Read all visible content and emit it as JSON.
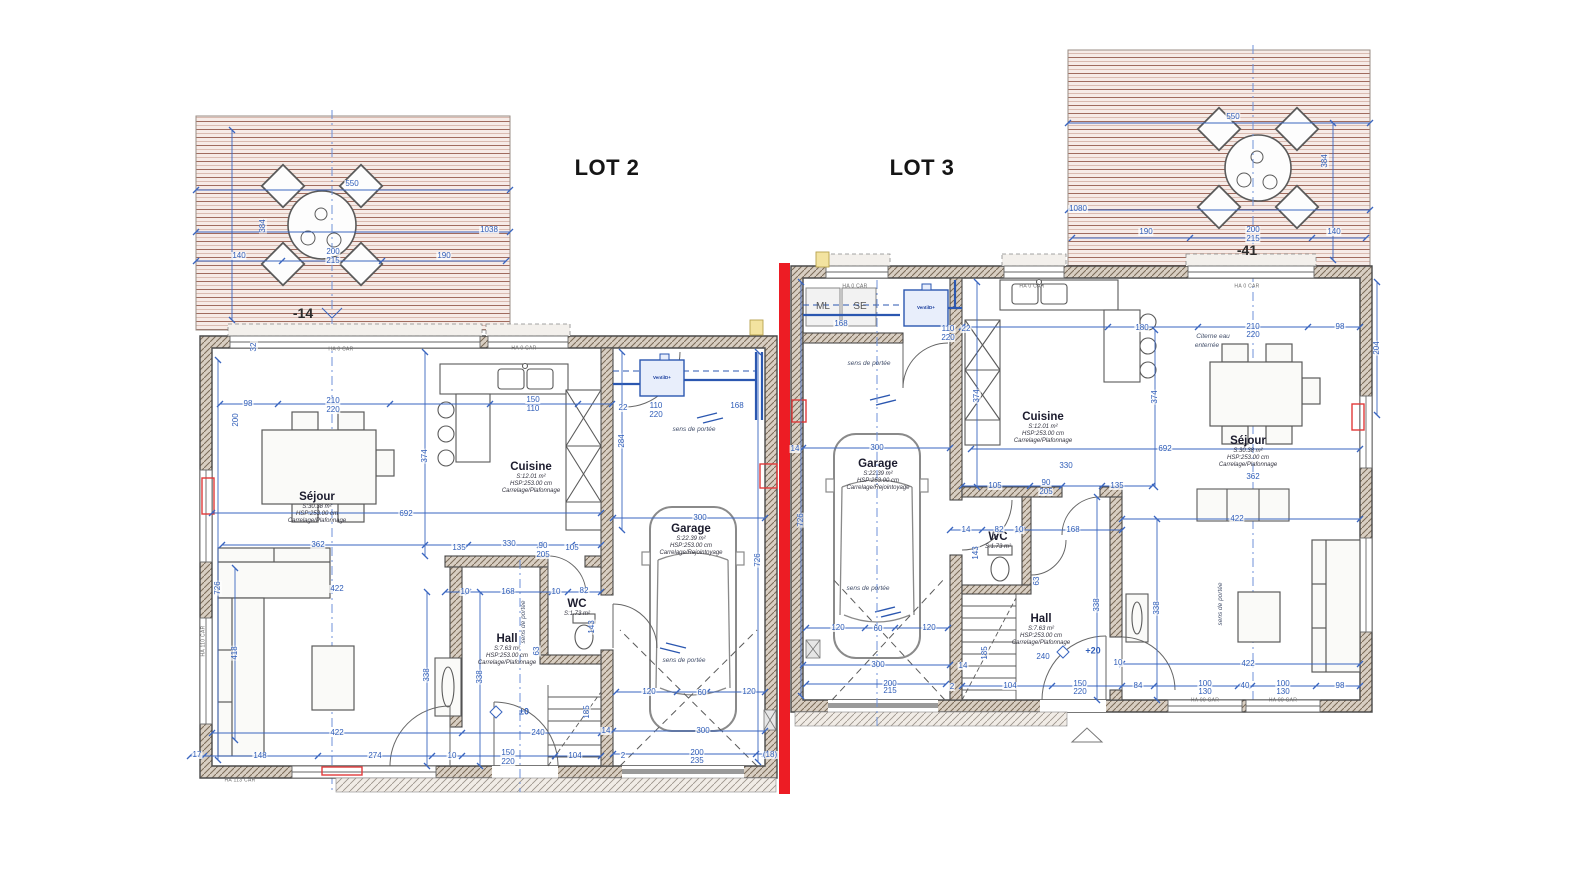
{
  "lots": {
    "lot2": "LOT 2",
    "lot3": "LOT 3"
  },
  "colors": {
    "dimension_blue": "#3a66c0",
    "axis_blue": "#6f92d8",
    "separation_red": "#ed1c24",
    "wall_gray": "#4a4a4a",
    "terrace_line": "#a06b5e",
    "terrace_bg": "#f6ebe7",
    "pipe_blue": "#2b57b0",
    "radiator_red": "#e03a3a"
  },
  "rooms": [
    {
      "name": "Séjour",
      "area": "S:30.38 m²",
      "hsp": "HSP:253.00 cm",
      "finish": "Carrelage/Plafonnage",
      "x": 317,
      "y": 508
    },
    {
      "name": "Cuisine",
      "area": "S:12.01 m²",
      "hsp": "HSP:253.00 cm",
      "finish": "Carrelage/Plafonnage",
      "x": 531,
      "y": 478
    },
    {
      "name": "Garage",
      "area": "S:22.39 m²",
      "hsp": "HSP:253.00 cm",
      "finish": "Carrelage/Rejointoyage",
      "x": 691,
      "y": 540
    },
    {
      "name": "Hall",
      "area": "S:7.63 m²",
      "hsp": "HSP:253.00 cm",
      "finish": "Carrelage/Plafonnage",
      "x": 507,
      "y": 650
    },
    {
      "name": "WC",
      "area": "S:1.73 m²",
      "x": 577,
      "y": 608
    },
    {
      "name": "Garage",
      "area": "S:22.39 m²",
      "hsp": "HSP:253.00 cm",
      "finish": "Carrelage/Rejointoyage",
      "x": 878,
      "y": 475
    },
    {
      "name": "Cuisine",
      "area": "S:12.01 m²",
      "hsp": "HSP:253.00 cm",
      "finish": "Carrelage/Plafonnage",
      "x": 1043,
      "y": 428
    },
    {
      "name": "Séjour",
      "area": "S:30.38 m²",
      "hsp": "HSP:253.00 cm",
      "finish": "Carrelage/Plafonnage",
      "x": 1248,
      "y": 452
    },
    {
      "name": "Hall",
      "area": "S:7.63 m²",
      "hsp": "HSP:253.00 cm",
      "finish": "Carrelage/Plafonnage",
      "x": 1041,
      "y": 630
    },
    {
      "name": "WC",
      "area": "S:1.73 m²",
      "x": 998,
      "y": 541
    }
  ],
  "dimensions": [
    {
      "t": "550",
      "x": 352,
      "y": 184
    },
    {
      "t": "1038",
      "x": 489,
      "y": 230
    },
    {
      "t": "384",
      "x": 263,
      "y": 226,
      "cls": "v"
    },
    {
      "t": "140",
      "x": 239,
      "y": 256
    },
    {
      "t": "190",
      "x": 444,
      "y": 256
    },
    {
      "t": "200",
      "x": 333,
      "y": 252
    },
    {
      "t": "215",
      "x": 333,
      "y": 261
    },
    {
      "t": "550",
      "x": 1233,
      "y": 117
    },
    {
      "t": "384",
      "x": 1325,
      "y": 161,
      "cls": "v"
    },
    {
      "t": "1080",
      "x": 1078,
      "y": 209
    },
    {
      "t": "190",
      "x": 1146,
      "y": 232
    },
    {
      "t": "200",
      "x": 1253,
      "y": 230
    },
    {
      "t": "215",
      "x": 1253,
      "y": 239
    },
    {
      "t": "140",
      "x": 1334,
      "y": 232
    },
    {
      "t": "98",
      "x": 248,
      "y": 404
    },
    {
      "t": "210",
      "x": 333,
      "y": 401
    },
    {
      "t": "220",
      "x": 333,
      "y": 410
    },
    {
      "t": "150",
      "x": 533,
      "y": 400
    },
    {
      "t": "110",
      "x": 533,
      "y": 409
    },
    {
      "t": "22",
      "x": 623,
      "y": 408
    },
    {
      "t": "110",
      "x": 656,
      "y": 406
    },
    {
      "t": "220",
      "x": 656,
      "y": 415
    },
    {
      "t": "168",
      "x": 737,
      "y": 406
    },
    {
      "t": "284",
      "x": 622,
      "y": 441,
      "cls": "v"
    },
    {
      "t": "374",
      "x": 425,
      "y": 456,
      "cls": "v"
    },
    {
      "t": "200",
      "x": 236,
      "y": 420,
      "cls": "v"
    },
    {
      "t": "32",
      "x": 254,
      "y": 347,
      "cls": "v"
    },
    {
      "t": "692",
      "x": 406,
      "y": 514
    },
    {
      "t": "362",
      "x": 318,
      "y": 545
    },
    {
      "t": "135",
      "x": 459,
      "y": 548
    },
    {
      "t": "330",
      "x": 509,
      "y": 544
    },
    {
      "t": "90",
      "x": 543,
      "y": 546
    },
    {
      "t": "205",
      "x": 543,
      "y": 555
    },
    {
      "t": "105",
      "x": 572,
      "y": 548
    },
    {
      "t": "300",
      "x": 700,
      "y": 518
    },
    {
      "t": "726",
      "x": 218,
      "y": 588,
      "cls": "v"
    },
    {
      "t": "726",
      "x": 758,
      "y": 560,
      "cls": "v"
    },
    {
      "t": "422",
      "x": 337,
      "y": 589
    },
    {
      "t": "10",
      "x": 465,
      "y": 592
    },
    {
      "t": "168",
      "x": 508,
      "y": 592
    },
    {
      "t": "10",
      "x": 556,
      "y": 592
    },
    {
      "t": "82",
      "x": 584,
      "y": 591
    },
    {
      "t": "63",
      "x": 537,
      "y": 651,
      "cls": "v"
    },
    {
      "t": "143",
      "x": 592,
      "y": 627,
      "cls": "v"
    },
    {
      "t": "422",
      "x": 337,
      "y": 733
    },
    {
      "t": "240",
      "x": 538,
      "y": 733
    },
    {
      "t": "17",
      "x": 197,
      "y": 755
    },
    {
      "t": "148",
      "x": 260,
      "y": 756
    },
    {
      "t": "274",
      "x": 375,
      "y": 756
    },
    {
      "t": "10",
      "x": 452,
      "y": 756
    },
    {
      "t": "150",
      "x": 508,
      "y": 753
    },
    {
      "t": "220",
      "x": 508,
      "y": 762
    },
    {
      "t": "104",
      "x": 575,
      "y": 756
    },
    {
      "t": "338",
      "x": 427,
      "y": 675,
      "cls": "v"
    },
    {
      "t": "338",
      "x": 480,
      "y": 677,
      "cls": "v"
    },
    {
      "t": "418",
      "x": 235,
      "y": 653,
      "cls": "v"
    },
    {
      "t": "185",
      "x": 587,
      "y": 712,
      "cls": "v"
    },
    {
      "t": "120",
      "x": 649,
      "y": 692
    },
    {
      "t": "60",
      "x": 702,
      "y": 693
    },
    {
      "t": "120",
      "x": 749,
      "y": 692
    },
    {
      "t": "300",
      "x": 703,
      "y": 731
    },
    {
      "t": "14",
      "x": 606,
      "y": 731
    },
    {
      "t": "2",
      "x": 623,
      "y": 756
    },
    {
      "t": "200",
      "x": 697,
      "y": 753
    },
    {
      "t": "235",
      "x": 697,
      "y": 761
    },
    {
      "t": "(18)",
      "x": 770,
      "y": 755
    },
    {
      "t": "168",
      "x": 841,
      "y": 324
    },
    {
      "t": "22",
      "x": 966,
      "y": 329
    },
    {
      "t": "110",
      "x": 948,
      "y": 329
    },
    {
      "t": "220",
      "x": 948,
      "y": 338
    },
    {
      "t": "180",
      "x": 1142,
      "y": 328
    },
    {
      "t": "210",
      "x": 1253,
      "y": 327
    },
    {
      "t": "220",
      "x": 1253,
      "y": 335
    },
    {
      "t": "98",
      "x": 1340,
      "y": 327
    },
    {
      "t": "204",
      "x": 1377,
      "y": 348,
      "cls": "v"
    },
    {
      "t": "374",
      "x": 977,
      "y": 396,
      "cls": "v"
    },
    {
      "t": "374",
      "x": 1155,
      "y": 397,
      "cls": "v"
    },
    {
      "t": "300",
      "x": 877,
      "y": 448
    },
    {
      "t": "14",
      "x": 795,
      "y": 449
    },
    {
      "t": "692",
      "x": 1165,
      "y": 449
    },
    {
      "t": "726",
      "x": 801,
      "y": 520,
      "cls": "v"
    },
    {
      "t": "330",
      "x": 1066,
      "y": 466
    },
    {
      "t": "105",
      "x": 995,
      "y": 486
    },
    {
      "t": "90",
      "x": 1046,
      "y": 483
    },
    {
      "t": "205",
      "x": 1046,
      "y": 492
    },
    {
      "t": "135",
      "x": 1117,
      "y": 486
    },
    {
      "t": "362",
      "x": 1253,
      "y": 477
    },
    {
      "t": "422",
      "x": 1237,
      "y": 519
    },
    {
      "t": "14",
      "x": 966,
      "y": 530
    },
    {
      "t": "82",
      "x": 999,
      "y": 530
    },
    {
      "t": "10",
      "x": 1019,
      "y": 530
    },
    {
      "t": "168",
      "x": 1073,
      "y": 530
    },
    {
      "t": "143",
      "x": 976,
      "y": 553,
      "cls": "v"
    },
    {
      "t": "63",
      "x": 1037,
      "y": 581,
      "cls": "v"
    },
    {
      "t": "338",
      "x": 1097,
      "y": 605,
      "cls": "v"
    },
    {
      "t": "338",
      "x": 1157,
      "y": 608,
      "cls": "v"
    },
    {
      "t": "185",
      "x": 985,
      "y": 653,
      "cls": "v"
    },
    {
      "t": "240",
      "x": 1043,
      "y": 657
    },
    {
      "t": "422",
      "x": 1248,
      "y": 664
    },
    {
      "t": "10",
      "x": 1118,
      "y": 663
    },
    {
      "t": "104",
      "x": 1010,
      "y": 686
    },
    {
      "t": "150",
      "x": 1080,
      "y": 684
    },
    {
      "t": "220",
      "x": 1080,
      "y": 692
    },
    {
      "t": "84",
      "x": 1138,
      "y": 686
    },
    {
      "t": "100",
      "x": 1205,
      "y": 684
    },
    {
      "t": "130",
      "x": 1205,
      "y": 692
    },
    {
      "t": "40",
      "x": 1245,
      "y": 686
    },
    {
      "t": "100",
      "x": 1283,
      "y": 684
    },
    {
      "t": "130",
      "x": 1283,
      "y": 692
    },
    {
      "t": "98",
      "x": 1340,
      "y": 686
    },
    {
      "t": "120",
      "x": 838,
      "y": 628
    },
    {
      "t": "60",
      "x": 878,
      "y": 629
    },
    {
      "t": "120",
      "x": 929,
      "y": 628
    },
    {
      "t": "300",
      "x": 878,
      "y": 665
    },
    {
      "t": "14",
      "x": 963,
      "y": 666
    },
    {
      "t": "200",
      "x": 890,
      "y": 684
    },
    {
      "t": "215",
      "x": 890,
      "y": 691
    },
    {
      "t": "2",
      "x": 952,
      "y": 687
    }
  ],
  "annotations": [
    {
      "t": "-14",
      "x": 303,
      "y": 313,
      "cls": "level"
    },
    {
      "t": "-41",
      "x": 1247,
      "y": 250,
      "cls": "level"
    },
    {
      "t": "±0",
      "x": 524,
      "y": 712,
      "cls": "level-blue"
    },
    {
      "t": "+20",
      "x": 1093,
      "y": 651,
      "cls": "level-blue"
    },
    {
      "t": "ML",
      "x": 823,
      "y": 307,
      "cls": "appliance"
    },
    {
      "t": "SE",
      "x": 860,
      "y": 307,
      "cls": "appliance"
    },
    {
      "t": "VentilD+",
      "x": 662,
      "y": 378,
      "cls": "ventil"
    },
    {
      "t": "VentilD+",
      "x": 926,
      "y": 308,
      "cls": "ventil"
    },
    {
      "t": "Citerne eau",
      "x": 1213,
      "y": 337,
      "cls": "note"
    },
    {
      "t": "enterrée",
      "x": 1207,
      "y": 346,
      "cls": "note"
    },
    {
      "t": "sens de portée",
      "x": 694,
      "y": 430,
      "cls": "note"
    },
    {
      "t": "sens de portée",
      "x": 684,
      "y": 661,
      "cls": "note"
    },
    {
      "t": "sens de portée",
      "x": 524,
      "y": 622,
      "cls": "note v"
    },
    {
      "t": "sens de portée",
      "x": 869,
      "y": 364,
      "cls": "note"
    },
    {
      "t": "sens de portée",
      "x": 868,
      "y": 589,
      "cls": "note"
    },
    {
      "t": "sens de portée",
      "x": 1221,
      "y": 604,
      "cls": "note v"
    },
    {
      "t": "HA 0  CAR",
      "x": 341,
      "y": 350,
      "cls": "win"
    },
    {
      "t": "HA 0  CAR",
      "x": 524,
      "y": 349,
      "cls": "win"
    },
    {
      "t": "HA 0  CAR",
      "x": 855,
      "y": 287,
      "cls": "win"
    },
    {
      "t": "HA 0  CAR",
      "x": 1032,
      "y": 287,
      "cls": "win"
    },
    {
      "t": "HA 0  CAR",
      "x": 1247,
      "y": 287,
      "cls": "win"
    },
    {
      "t": "HA 90  CAR",
      "x": 1205,
      "y": 701,
      "cls": "win"
    },
    {
      "t": "HA 90  CAR",
      "x": 1283,
      "y": 701,
      "cls": "win"
    },
    {
      "t": "HA 113  CAR",
      "x": 240,
      "y": 781,
      "cls": "win"
    },
    {
      "t": "HA 110  CAR",
      "x": 204,
      "y": 641,
      "cls": "win v"
    }
  ]
}
